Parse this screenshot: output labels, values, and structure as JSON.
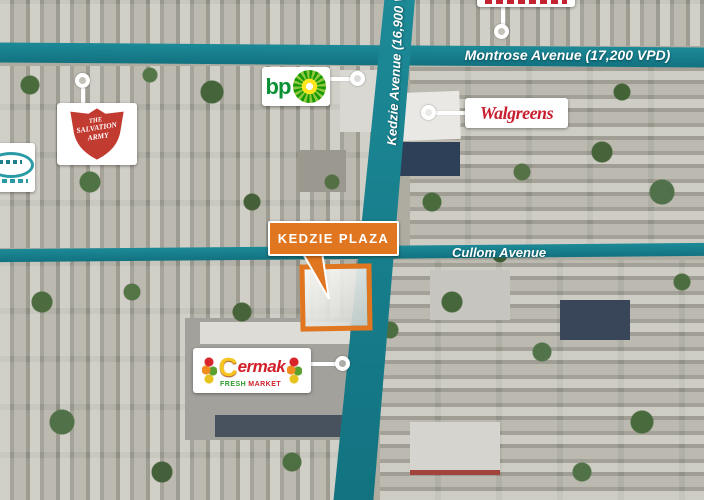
{
  "streets": {
    "montrose": {
      "label": "Montrose Avenue (17,200 VPD)"
    },
    "kedzie": {
      "label": "Kedzie Avenue (16,900 VPD)"
    },
    "cullom": {
      "label": "Cullom Avenue"
    }
  },
  "site": {
    "callout_label": "KEDZIE PLAZA"
  },
  "businesses": {
    "bp": {
      "name": "bp"
    },
    "walgreens": {
      "name": "Walgreens"
    },
    "salvation_army": {
      "line1": "THE",
      "line2": "SALVATION",
      "line3": "ARMY"
    },
    "cermak": {
      "initial": "C",
      "rest": "ermak",
      "fresh": "FRESH",
      "market": "MARKET"
    }
  },
  "colors": {
    "road_teal": "#17818f",
    "callout_orange": "#e0761f",
    "site_outline_orange": "#e0761f",
    "walgreens_red": "#c8202f",
    "bp_green": "#0a9134",
    "salvation_red": "#c23b31",
    "cermak_yellow": "#f6c51e",
    "cermak_red": "#d2202a",
    "cermak_green": "#2e9b2e"
  }
}
